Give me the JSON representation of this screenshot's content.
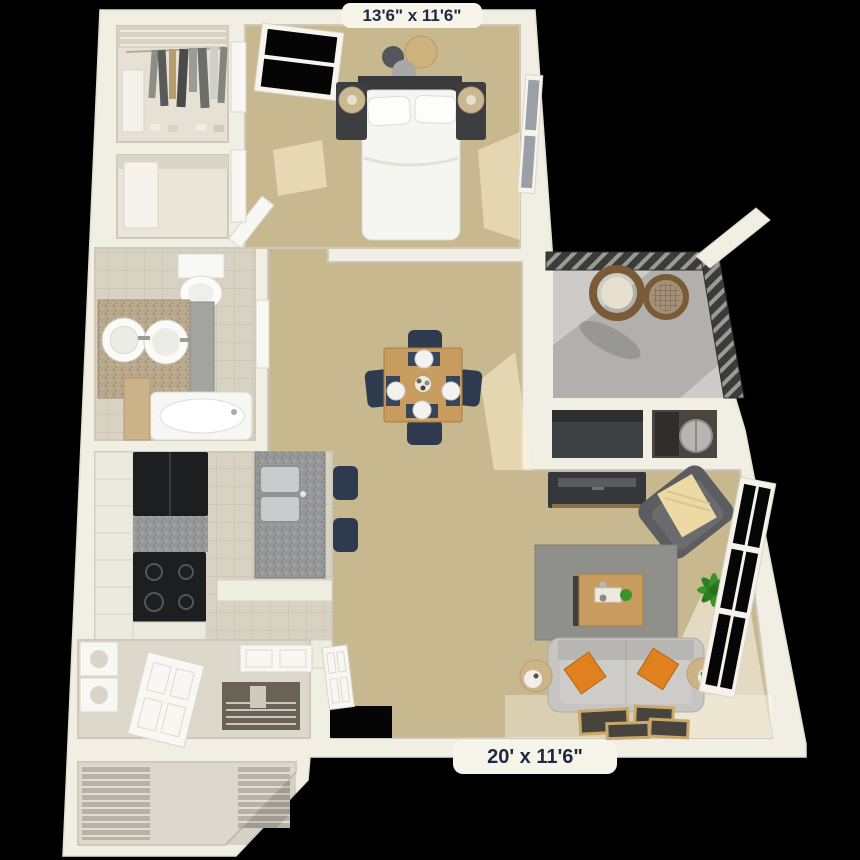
{
  "labels": {
    "bedroom_dimensions": "13'6\" x 11'6\"",
    "living_room_dimensions": "20' x 11'6\""
  },
  "palette": {
    "background": "#000000",
    "wall": "#f1eee4",
    "wall_shade": "#d9d4c6",
    "carpet": "#c7b890",
    "tile": "#d8d2c3",
    "tile_line": "#c5beac",
    "balcony_floor": "#cccbc7",
    "railing": "#3b3b39",
    "navy": "#2e3a4e",
    "wood": "#c89b5e",
    "rug": "#8f8f8c",
    "sofa": "#c6c5c2",
    "orange": "#e0801f",
    "charcoal": "#1d1e20",
    "granite": "#96989a",
    "vanity_granite": "#b9a88c",
    "label_bg": "#f7f4ea",
    "label_text": "#1e2946",
    "plant": "#3b9428",
    "wicker": "#7a5b38",
    "throw": "#ecd9a4"
  }
}
